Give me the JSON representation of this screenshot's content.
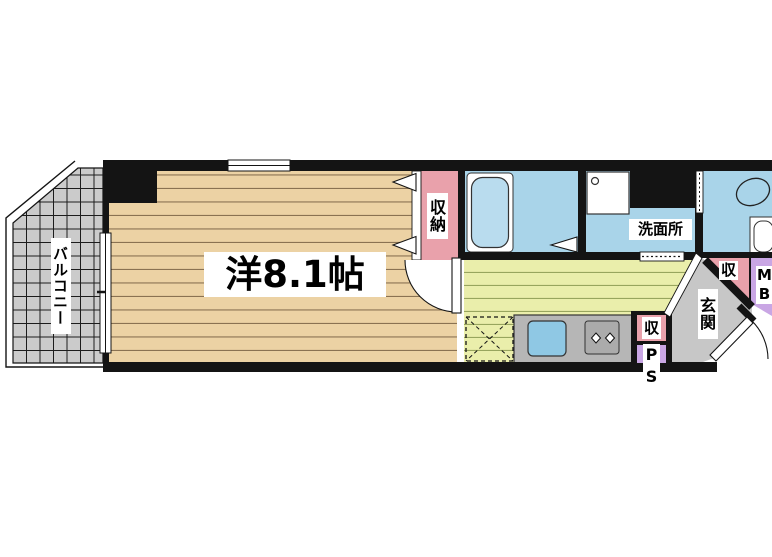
{
  "type": "apartment-floorplan",
  "rooms": {
    "balcony": "バルコニー",
    "main_room": "洋8.1帖",
    "closet": "収納",
    "washroom": "洗面所",
    "entrance": "玄関",
    "hall_storage": "収",
    "kitchen_storage": "収",
    "pipe_space": "PS",
    "meter_box": "MB"
  },
  "fixtures": [
    "bathtub-icon",
    "washing-machine-pan-icon",
    "toilet-icon",
    "kitchen-sink-icon",
    "gas-stove-icon",
    "refrigerator-space-icon",
    "door-swing-arc-icon",
    "sliding-window-icon",
    "closet-door-arrow-icon"
  ],
  "colors": {
    "wood_floor": "#ecd2a4",
    "balcony_tile": "#cccccc",
    "closet_pink": "#e9a1ab",
    "wet_area_blue": "#a9d4e9",
    "kitchen_green": "#eaeeab",
    "entrance_gray": "#c7c7c7",
    "utility_purple": "#c9a6e4",
    "counter_gray": "#b6b6b6",
    "sink_blue": "#8fc8e4",
    "wall_black": "#141414"
  }
}
